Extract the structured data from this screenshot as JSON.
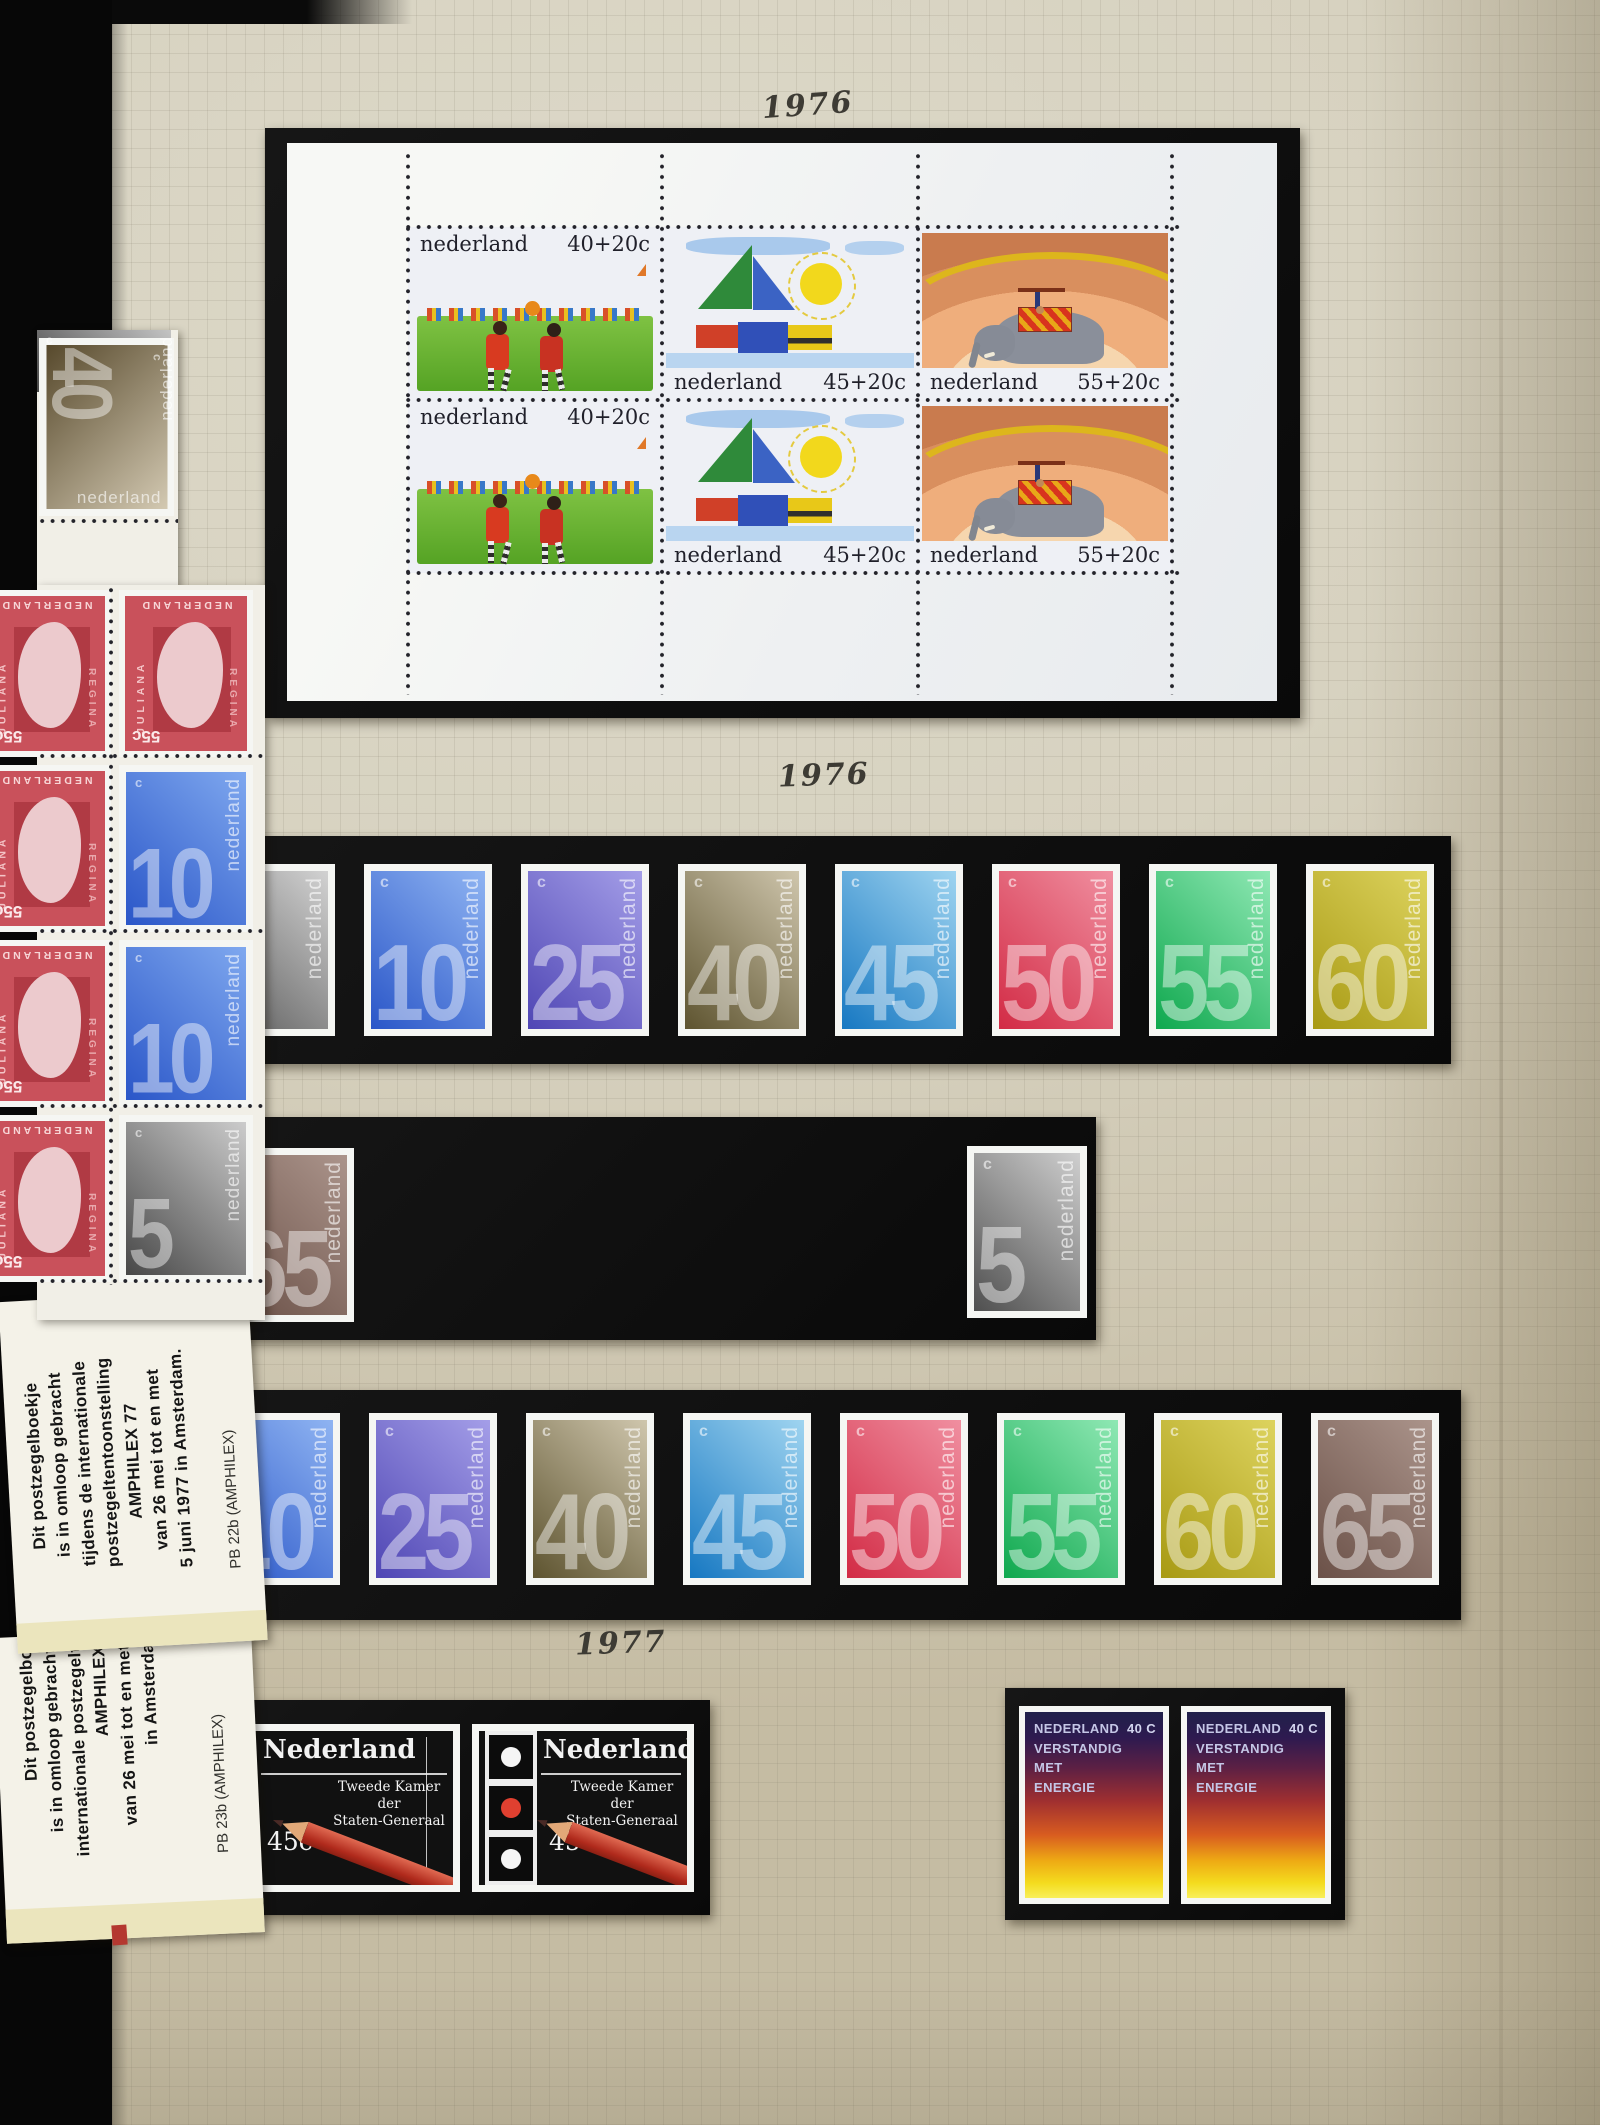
{
  "years": {
    "top": "1976",
    "middle": "1976",
    "bottom": "1977"
  },
  "souvenir_sheet": {
    "country": "nederland",
    "rows": 2,
    "stamps": [
      {
        "design": "children-playing-with-ball",
        "denomination": "40+20c",
        "caption_position": "top"
      },
      {
        "design": "sailboat-and-sun",
        "denomination": "45+20c",
        "caption_position": "bottom"
      },
      {
        "design": "circus-elephant-with-acrobat",
        "denomination": "55+20c",
        "caption_position": "bottom"
      }
    ]
  },
  "numeral_series": {
    "country": "nederland",
    "currency_symbol": "c"
  },
  "strips": [
    {
      "stamps": [
        {
          "value": "5",
          "colors": [
            "#5a5a5a",
            "#d2d2d2"
          ],
          "hidden_left": true
        },
        {
          "value": "10",
          "colors": [
            "#2a56c8",
            "#8fb4f2"
          ]
        },
        {
          "value": "25",
          "colors": [
            "#4f46b4",
            "#a49ee8"
          ]
        },
        {
          "value": "40",
          "colors": [
            "#5e5430",
            "#cfc6ad"
          ]
        },
        {
          "value": "45",
          "colors": [
            "#1778c2",
            "#9fd4f0"
          ]
        },
        {
          "value": "50",
          "colors": [
            "#d22b45",
            "#f08fa0"
          ]
        },
        {
          "value": "55",
          "colors": [
            "#0fa84e",
            "#8fe8b4"
          ]
        },
        {
          "value": "60",
          "colors": [
            "#a89a14",
            "#ddd35e"
          ]
        }
      ]
    },
    {
      "stamps": [
        {
          "value": "65",
          "colors": [
            "#6b5148",
            "#ab948b"
          ],
          "hidden_left": true
        },
        {
          "value": "5",
          "colors": [
            "#4f4f4f",
            "#cfcfcf"
          ],
          "position": "right"
        }
      ]
    },
    {
      "stamps": [
        {
          "value": "10",
          "colors": [
            "#2a56c8",
            "#8fb4f2"
          ],
          "hidden_left": true
        },
        {
          "value": "25",
          "colors": [
            "#4f46b4",
            "#a49ee8"
          ]
        },
        {
          "value": "40",
          "colors": [
            "#5e5430",
            "#cfc6ad"
          ]
        },
        {
          "value": "45",
          "colors": [
            "#1778c2",
            "#9fd4f0"
          ]
        },
        {
          "value": "50",
          "colors": [
            "#d22b45",
            "#f08fa0"
          ]
        },
        {
          "value": "55",
          "colors": [
            "#0fa84e",
            "#8fe8b4"
          ]
        },
        {
          "value": "60",
          "colors": [
            "#a89a14",
            "#ddd35e"
          ]
        },
        {
          "value": "65",
          "colors": [
            "#6b5148",
            "#ab948b"
          ]
        }
      ]
    }
  ],
  "booklet_pane": {
    "rotated_stamp": {
      "value": "40",
      "colors": [
        "#57492c",
        "#d3c9b2"
      ]
    },
    "fragment_stamp": {
      "colors": [
        "#474747",
        "#c4c4c4"
      ]
    },
    "juliana": {
      "value": "55c",
      "name": "JULIANA",
      "title": "REGINA",
      "country": "NEDERLAND",
      "colors": {
        "background": "#c9515b",
        "panel": "#b03a44",
        "profile": "#eccacd"
      }
    },
    "rows": [
      [
        "juliana",
        "juliana"
      ],
      [
        "juliana",
        "10"
      ],
      [
        "juliana",
        "10"
      ],
      [
        "juliana",
        "5"
      ]
    ],
    "blue_colors": [
      "#2a56c8",
      "#7fa8ef"
    ],
    "grey_colors": [
      "#474747",
      "#cccccc"
    ],
    "blue_value": "10",
    "grey_value": "5"
  },
  "booklet_covers": [
    {
      "lines": [
        "Dit postzegelboekje",
        "is in omloop gebracht",
        "tijdens de internationale",
        "postzegeltentoonstelling",
        "AMPHILEX  77",
        "van 26 mei tot en met",
        "5 juni 1977 in Amsterdam."
      ],
      "catalog": "PB 22b (AMPHILEX)"
    },
    {
      "lines": [
        "Dit postzegelbo",
        "is in omloop gebracht",
        "internationale postzegelt",
        "AMPHILEX",
        "van 26 mei tot en met",
        "in Amsterda"
      ],
      "catalog": "PB 23b (AMPHILEX)"
    }
  ],
  "tweede_kamer": {
    "country": "Nederland",
    "line1": "Tweede Kamer der",
    "line2": "Staten-Generaal",
    "value": "45c",
    "count": 2,
    "colors": {
      "background": "#111111",
      "pencil": "#c0392b",
      "ballot_dot": "#e04030"
    }
  },
  "energy": {
    "country": "NEDERLAND",
    "value": "40 C",
    "lines": [
      "VERSTANDIG",
      "MET",
      "ENERGIE"
    ],
    "count": 2,
    "colors": {
      "top": "#20204a",
      "middle": "#a02f30",
      "bottom": "#f4dc1e"
    }
  }
}
